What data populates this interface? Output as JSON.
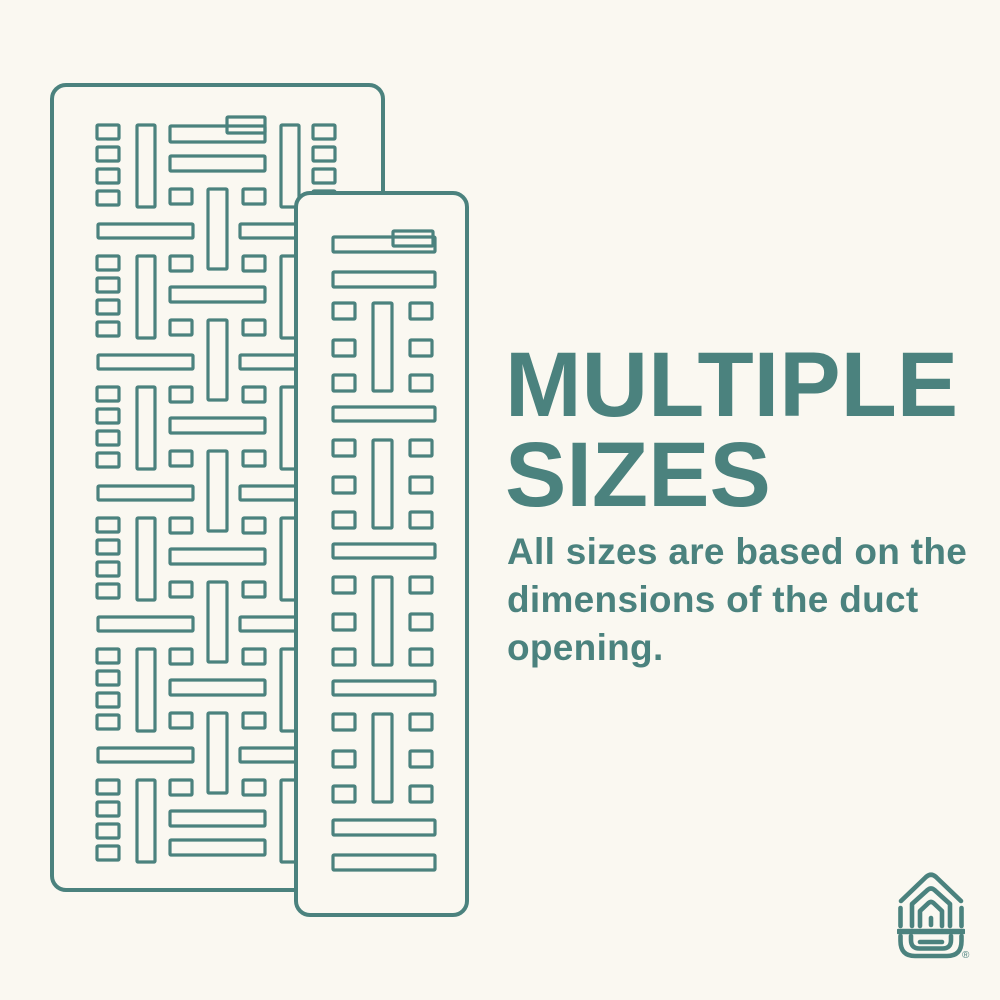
{
  "colors": {
    "background": "#FAF8F1",
    "accent": "#4B827E"
  },
  "heading": {
    "lines": [
      "MULTIPLE",
      "SIZES"
    ]
  },
  "body": {
    "lines": [
      "All sizes are based on the",
      "dimensions of the duct",
      "opening."
    ]
  },
  "logo": {
    "name": "house-vent-logo",
    "registered_mark": "®"
  }
}
